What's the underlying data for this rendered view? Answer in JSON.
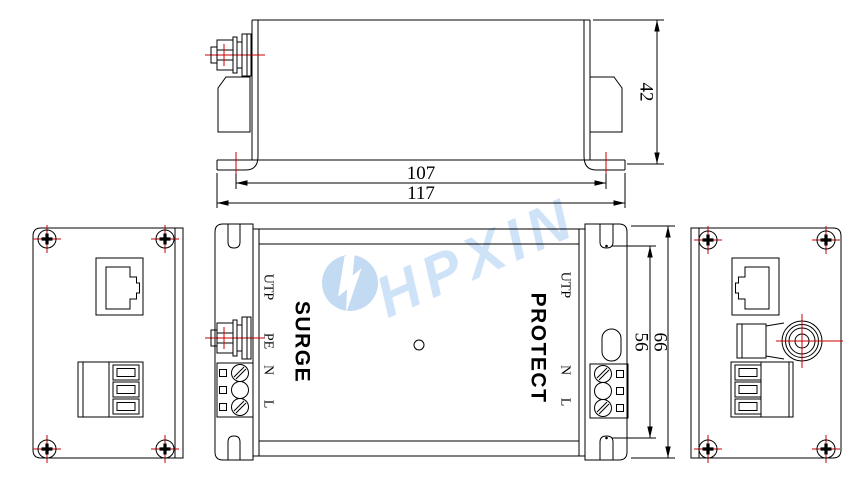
{
  "colors": {
    "line": "#000000",
    "centerline_red": "#cc0000",
    "watermark_fill": "#c3daf3",
    "watermark_text": "#cee2f8",
    "background": "#ffffff"
  },
  "watermark": {
    "brand": "HPXIN"
  },
  "top_view": {
    "dim_hole_span": "107",
    "dim_overall_width": "117",
    "dim_height": "42"
  },
  "front_view": {
    "brand_left": "SURGE",
    "brand_right": "PROTECT",
    "port_label_left": "UTP",
    "terminal_labels_left": [
      "PE",
      "N",
      "L"
    ],
    "port_label_right": "UTP",
    "terminal_labels_right": [
      "N",
      "L"
    ],
    "dim_slot_span": "56",
    "dim_overall_height": "66"
  }
}
